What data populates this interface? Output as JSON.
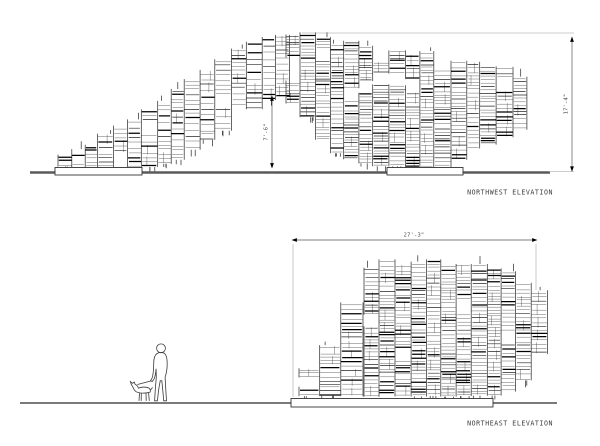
{
  "sheet": {
    "background": "#ffffff"
  },
  "colors": {
    "ink": "#262626",
    "thin_line": "#575757",
    "dark_line": "#000000",
    "ground_nw": "#5a5a5a",
    "ground_ne": "#2a2a2a",
    "dim_line": "#555555",
    "ext_line": "#9b9b9b",
    "label_text": "#3d3d3d"
  },
  "nw": {
    "label": "NORTHWEST ELEVATION",
    "dim_right": {
      "label": "17'-4\""
    },
    "dim_mid": {
      "label": "7'-6\""
    }
  },
  "ne": {
    "label": "NORTHEAST ELEVATION",
    "dim_width": {
      "label": "27'-3\""
    }
  },
  "scene": {
    "seed": 20240613,
    "nw_limb_profile": [
      [
        58,
        161,
        167
      ],
      [
        76,
        152,
        167
      ],
      [
        96,
        142,
        167
      ],
      [
        116,
        130,
        167
      ],
      [
        136,
        118,
        167
      ],
      [
        156,
        105,
        166
      ],
      [
        176,
        93,
        160
      ],
      [
        196,
        77,
        148
      ],
      [
        216,
        64,
        135
      ],
      [
        236,
        52,
        122
      ],
      [
        256,
        41,
        108
      ],
      [
        272,
        34,
        99
      ],
      [
        286,
        32,
        97
      ]
    ],
    "nw_mass_profile": [
      [
        286,
        32,
        100
      ],
      [
        300,
        33,
        106
      ],
      [
        316,
        36,
        131
      ],
      [
        334,
        40,
        152
      ],
      [
        354,
        44,
        160
      ],
      [
        374,
        47,
        165
      ],
      [
        390,
        49,
        167
      ],
      [
        412,
        52,
        167
      ],
      [
        434,
        54,
        167
      ],
      [
        455,
        57,
        167
      ],
      [
        464,
        59,
        152
      ],
      [
        480,
        63,
        147
      ],
      [
        497,
        67,
        141
      ],
      [
        511,
        72,
        134
      ],
      [
        522,
        78,
        128
      ]
    ],
    "ne_left_profile": [
      [
        299,
        374,
        396
      ],
      [
        312,
        369,
        396
      ],
      [
        324,
        352,
        396
      ],
      [
        338,
        334,
        396
      ],
      [
        352,
        303,
        396
      ],
      [
        364,
        278,
        396
      ]
    ],
    "ne_mass_profile": [
      [
        364,
        270,
        396
      ],
      [
        376,
        263,
        396
      ],
      [
        394,
        261,
        396
      ],
      [
        414,
        262,
        396
      ],
      [
        434,
        260,
        396
      ],
      [
        454,
        263,
        396
      ],
      [
        472,
        262,
        396
      ],
      [
        488,
        264,
        396
      ],
      [
        500,
        267,
        396
      ],
      [
        508,
        272,
        391
      ],
      [
        518,
        276,
        387
      ],
      [
        528,
        284,
        376
      ],
      [
        538,
        291,
        367
      ]
    ]
  }
}
